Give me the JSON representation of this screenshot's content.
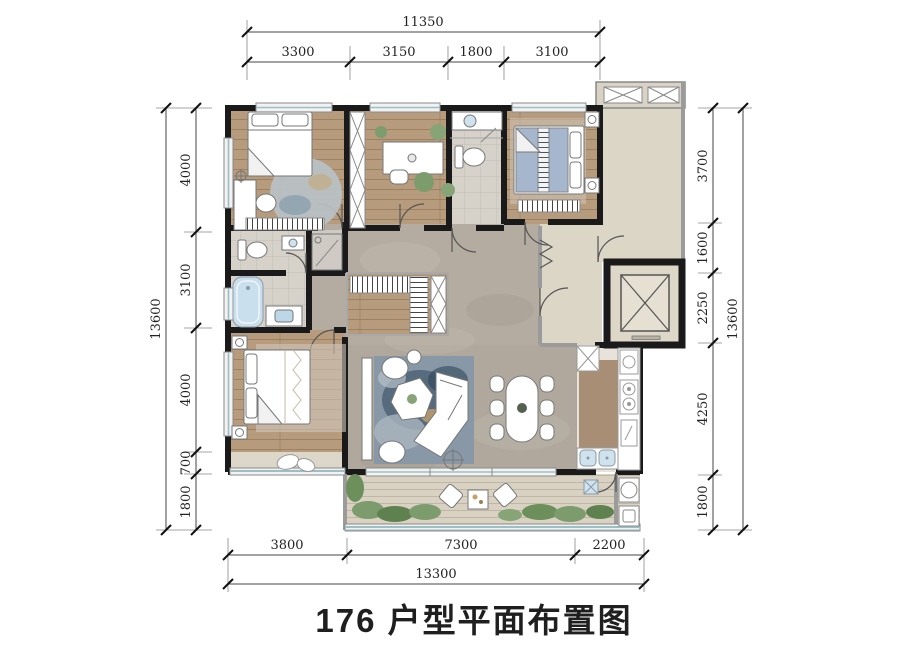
{
  "title": "176 户型平面布置图",
  "dims": {
    "top": {
      "overall": "11350",
      "segments": [
        "3300",
        "3150",
        "1800",
        "3100"
      ]
    },
    "left": {
      "overall": "13600",
      "segments": [
        "4000",
        "3100",
        "4000",
        "700",
        "1800"
      ]
    },
    "right": {
      "overall": "13600",
      "segments": [
        "3700",
        "1600",
        "2250",
        "4250",
        "1800"
      ]
    },
    "bottom": {
      "overall": "13300",
      "segments": [
        "3800",
        "7300",
        "2200"
      ]
    }
  },
  "colors": {
    "wall": "#1a1a1a",
    "wood_floor": "#b79b7d",
    "marble_floor": "#b4aca1",
    "tile_floor": "#d6d2ca",
    "public_floor": "#dcd6c7",
    "balcony_floor": "#d9d2c3",
    "glass": "#9dbfc3",
    "water_fixture": "#c9dfee",
    "rug_blue": "#8898a6",
    "plant_green": "#7d9c6d",
    "bedding_blue": "#9db0c8",
    "title_text": "#1f1f1f"
  }
}
